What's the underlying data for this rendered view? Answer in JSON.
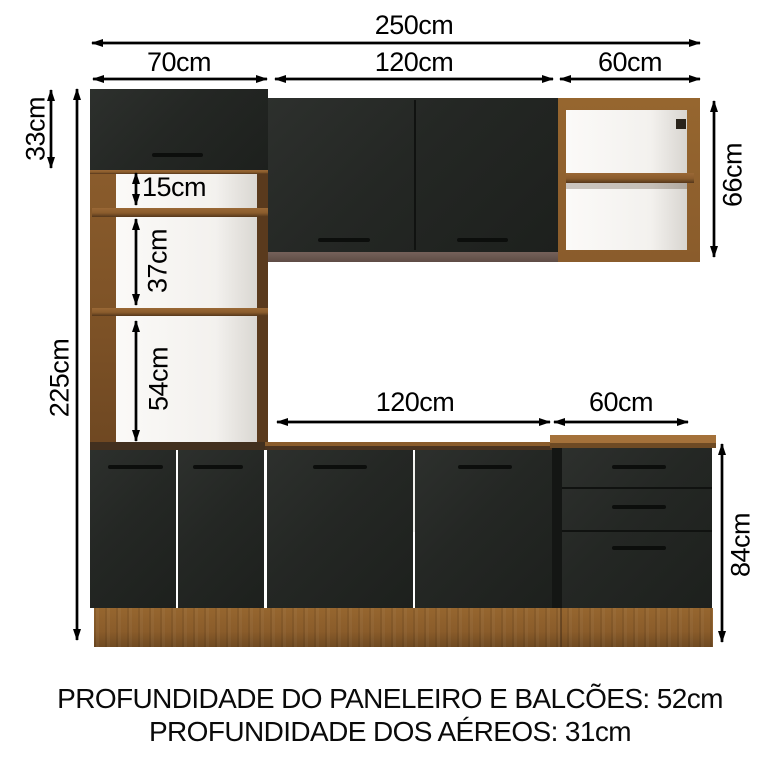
{
  "diagram": {
    "type": "kitchen-cabinet-dimension-diagram",
    "dims": {
      "total_width": "250cm",
      "top_left_width": "70cm",
      "top_mid_width": "120cm",
      "top_right_width": "60cm",
      "tower_door_height": "33cm",
      "total_height": "225cm",
      "shelf_gap_small": "15cm",
      "shelf_gap_mid": "37cm",
      "shelf_gap_large": "54cm",
      "wall_cabinet_height": "66cm",
      "base_mid_width": "120cm",
      "base_right_width": "60cm",
      "base_height": "84cm"
    },
    "notes": {
      "line1": "PROFUNDIDADE DO PANELEIRO E BALCÕES: 52cm",
      "line2": "PROFUNDIDADE DOS AÉREOS: 31cm"
    }
  },
  "colors": {
    "background": "#ffffff",
    "door_black": "#242724",
    "wood_mid": "#8a5c2c",
    "wood_light": "#a06d36",
    "wood_dark": "#5a3a1d",
    "counter_dark": "#42301f",
    "cabinet_bottom_strip": "#6b5751",
    "annotation": "#000000"
  }
}
